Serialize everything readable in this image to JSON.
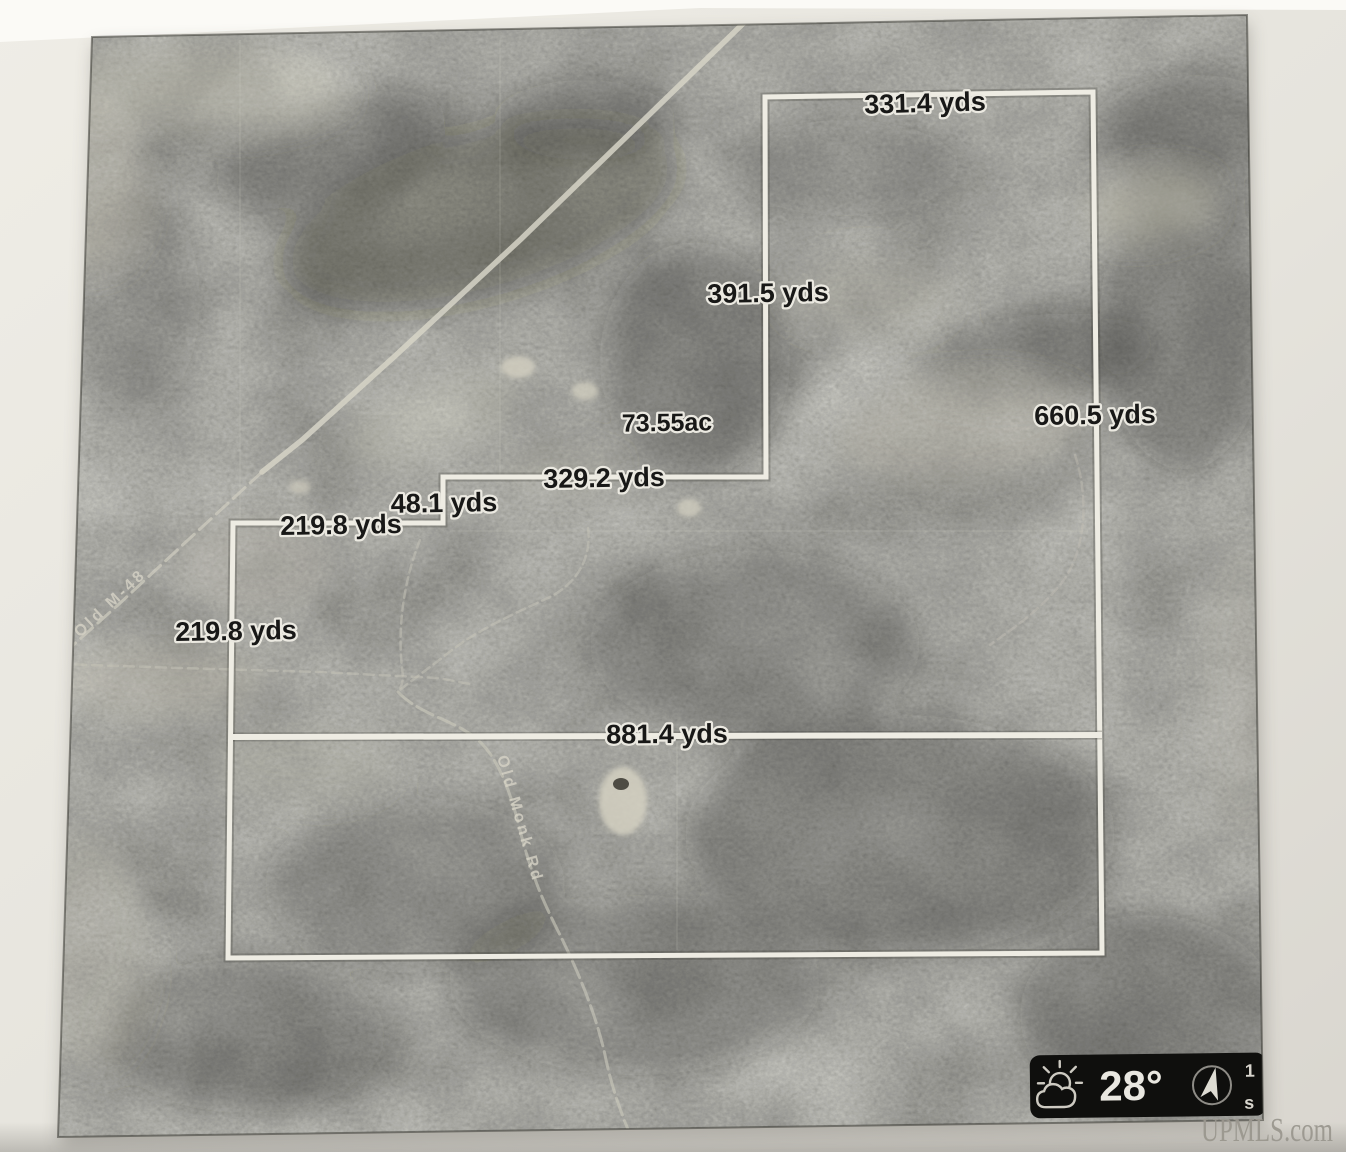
{
  "map": {
    "area_label": "73.55ac",
    "measurements": {
      "top": "331.4 yds",
      "upper_west": "391.5 yds",
      "step_north": "329.2 yds",
      "step_jog": "48.1 yds",
      "step_west": "219.8 yds",
      "west": "219.8 yds",
      "east": "660.5 yds",
      "middle": "881.4 yds"
    },
    "roads": {
      "highway": "Old M-48",
      "trail": "Old Monk Rd"
    },
    "widget": {
      "temperature": "28°",
      "marker_top": "1",
      "marker_bottom": "s"
    },
    "watermark": "UPMLS.com"
  },
  "colors": {
    "paper": "#e9e7e0",
    "photo_base": "#5a5954",
    "boundary_line": "#f5f3ea",
    "label_text": "#141414",
    "label_halo": "#f2f0e8",
    "widget_bg": "#0a0a09",
    "watermark_gray": "#9a978f"
  }
}
